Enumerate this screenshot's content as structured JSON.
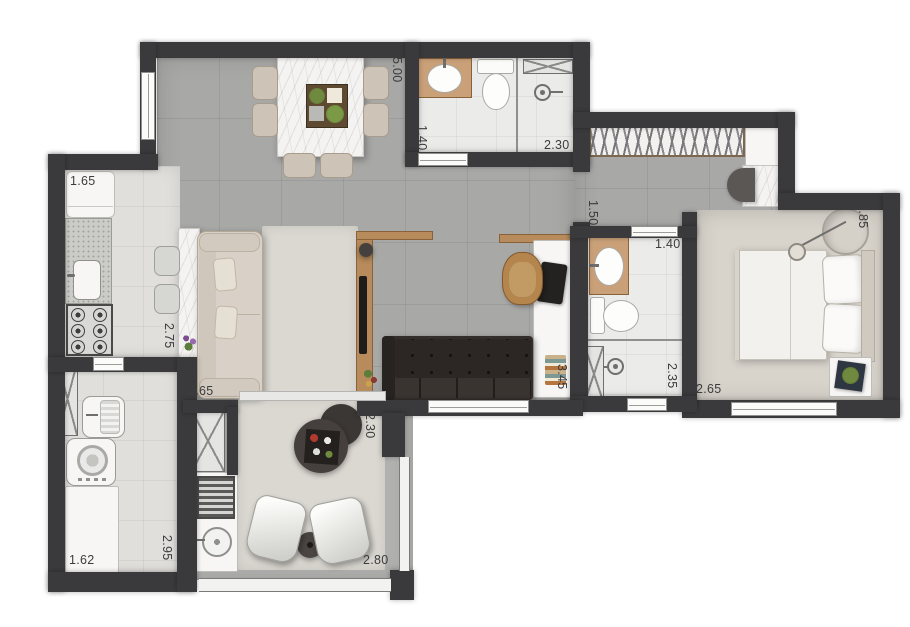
{
  "plan": {
    "type": "apartment-floor-plan",
    "colors": {
      "wall": "#3a3a3c",
      "floor_social": "#a8a8a6",
      "floor_service": "#e0dfdb",
      "floor_bedroom": "#d8d4cc",
      "wood": "#b78b5c",
      "marble": "#f4f3f1",
      "dark_furniture": "#332e2b",
      "label_text": "#3c3c3e"
    },
    "dimensions": [
      {
        "id": "living-dining-depth",
        "value": "5.00",
        "orientation": "vertical"
      },
      {
        "id": "bathroom1-width",
        "value": "1.40",
        "orientation": "vertical"
      },
      {
        "id": "bathroom1-length",
        "value": "2.30",
        "orientation": "horizontal"
      },
      {
        "id": "hall-width",
        "value": "1.50",
        "orientation": "vertical"
      },
      {
        "id": "bathroom2-width",
        "value": "1.40",
        "orientation": "horizontal"
      },
      {
        "id": "bedroom-depth",
        "value": "2.85",
        "orientation": "vertical"
      },
      {
        "id": "kitchen-width",
        "value": "1.65",
        "orientation": "horizontal"
      },
      {
        "id": "kitchen-depth",
        "value": "2.75",
        "orientation": "vertical"
      },
      {
        "id": "living-width",
        "value": "5.65",
        "orientation": "horizontal"
      },
      {
        "id": "study-depth",
        "value": "3.45",
        "orientation": "vertical"
      },
      {
        "id": "bathroom2-depth",
        "value": "2.35",
        "orientation": "vertical"
      },
      {
        "id": "bedroom-width",
        "value": "2.65",
        "orientation": "horizontal"
      },
      {
        "id": "balcony-depth",
        "value": "2.30",
        "orientation": "vertical"
      },
      {
        "id": "laundry-depth",
        "value": "2.95",
        "orientation": "vertical"
      },
      {
        "id": "laundry-width",
        "value": "1.62",
        "orientation": "horizontal"
      },
      {
        "id": "balcony-width",
        "value": "2.80",
        "orientation": "horizontal"
      }
    ],
    "rooms": [
      {
        "name": "dining",
        "furniture": [
          "marble-dining-table",
          "six-chairs",
          "centerpiece-tray"
        ]
      },
      {
        "name": "kitchen",
        "furniture": [
          "fridge",
          "counter-with-sink",
          "cooktop-6-burners",
          "breakfast-bar",
          "two-stools"
        ]
      },
      {
        "name": "living",
        "furniture": [
          "sofa",
          "tv-panel",
          "tv"
        ]
      },
      {
        "name": "study",
        "furniture": [
          "desk",
          "desk-chair",
          "laptop",
          "books",
          "dark-sofa"
        ]
      },
      {
        "name": "bathroom-1",
        "furniture": [
          "vanity-sink",
          "toilet",
          "shower",
          "niche"
        ]
      },
      {
        "name": "hall-closet",
        "furniture": [
          "wardrobe-hangers",
          "cabinet",
          "vanity",
          "stool"
        ]
      },
      {
        "name": "bathroom-2",
        "furniture": [
          "vanity-sink",
          "toilet",
          "shower",
          "duct"
        ]
      },
      {
        "name": "bedroom",
        "furniture": [
          "double-bed",
          "pillows",
          "nightstand",
          "plant",
          "decor-lamp"
        ]
      },
      {
        "name": "laundry",
        "furniture": [
          "tank-sink",
          "washer",
          "counter",
          "duct"
        ]
      },
      {
        "name": "balcony",
        "furniture": [
          "coffee-tables",
          "two-armchairs",
          "side-table",
          "grill",
          "round-sink",
          "glass-railing"
        ]
      }
    ]
  }
}
